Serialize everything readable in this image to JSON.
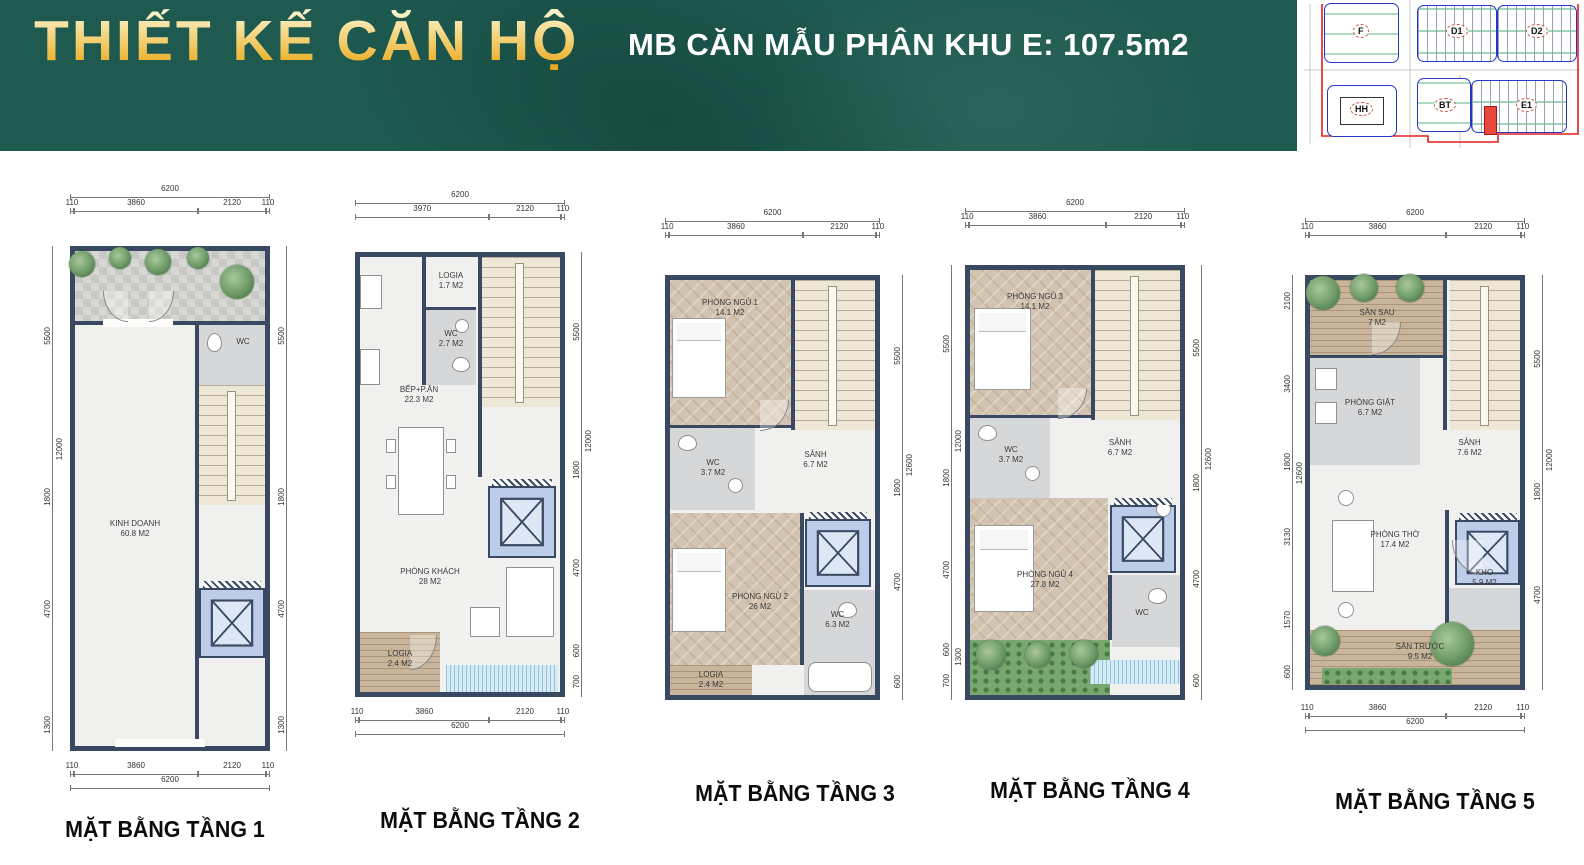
{
  "header": {
    "title": "THIẾT KẾ CĂN HỘ",
    "subtitle": "MB CĂN MẪU PHÂN KHU E: 107.5m2",
    "bg_color": "#1e5a50",
    "title_gold": "#eaa614"
  },
  "site_plan": {
    "blocks": {
      "f": "F",
      "d1": "D1",
      "d2": "D2",
      "hh": "HH",
      "bt": "BT",
      "e1": "E1"
    },
    "outline_color": "#2436c8",
    "boundary_color": "#e02020",
    "highlight_color": "#e8483e"
  },
  "plans": [
    {
      "title": "MẶT BẰNG TẦNG 1",
      "dims": {
        "top_total": "6200",
        "top_segments": [
          "110",
          "3860",
          "2120",
          "110"
        ],
        "left_segments": [
          "5500",
          "1800",
          "4700",
          "1300"
        ],
        "left_total": "12000",
        "right_segments": [
          "5500",
          "1800",
          "4700",
          "1300"
        ],
        "bottom_segments": [
          "110",
          "3860",
          "2120",
          "110"
        ],
        "bottom_total": "6200"
      },
      "rooms": {
        "kinh_doanh": {
          "name": "KINH DOANH",
          "area": "60.8 M2"
        },
        "wc": {
          "name": "WC",
          "area": ""
        }
      }
    },
    {
      "title": "MẶT BẰNG TẦNG 2",
      "dims": {
        "top_total": "6200",
        "top_segments": [
          "3970",
          "2120",
          "110"
        ],
        "right_segments": [
          "5500",
          "1800",
          "4700",
          "600",
          "700"
        ],
        "right_total": "12000",
        "bottom_segments": [
          "110",
          "3860",
          "2120",
          "110"
        ],
        "bottom_total": "6200"
      },
      "rooms": {
        "logia_top": {
          "name": "LOGIA",
          "area": "1.7 M2"
        },
        "wc": {
          "name": "WC",
          "area": "2.7 M2"
        },
        "bep": {
          "name": "BẾP+P.ĂN",
          "area": "22.3 M2"
        },
        "khach": {
          "name": "PHÒNG KHÁCH",
          "area": "28 M2"
        },
        "logia_bottom": {
          "name": "LOGIA",
          "area": "2.4 M2"
        }
      }
    },
    {
      "title": "MẶT BẰNG TẦNG 3",
      "dims": {
        "top_total": "6200",
        "top_segments": [
          "110",
          "3860",
          "2120",
          "110"
        ],
        "right_segments": [
          "5500",
          "1800",
          "4700",
          "600"
        ],
        "right_total": "12600"
      },
      "rooms": {
        "ngu1": {
          "name": "PHÒNG NGỦ 1",
          "area": "14.1 M2"
        },
        "wc1": {
          "name": "WC",
          "area": "3.7 M2"
        },
        "sanh": {
          "name": "SẢNH",
          "area": "6.7 M2"
        },
        "ngu2": {
          "name": "PHÒNG NGỦ 2",
          "area": "26 M2"
        },
        "wc2": {
          "name": "WC",
          "area": "6.3 M2"
        },
        "logia": {
          "name": "LOGIA",
          "area": "2.4 M2"
        }
      }
    },
    {
      "title": "MẶT BẰNG TẦNG 4",
      "dims": {
        "top_total": "6200",
        "top_segments": [
          "110",
          "3860",
          "2120",
          "110"
        ],
        "left_segments": [
          "5500",
          "1800",
          "4700",
          "600",
          "700"
        ],
        "left_total": "12000",
        "left_extra": "1300",
        "right_segments": [
          "5500",
          "1800",
          "4700",
          "600"
        ],
        "right_total": "12600"
      },
      "rooms": {
        "ngu3": {
          "name": "PHÒNG NGỦ 3",
          "area": "14.1 M2"
        },
        "wc1": {
          "name": "WC",
          "area": "3.7 M2"
        },
        "sanh": {
          "name": "SẢNH",
          "area": "6.7 M2"
        },
        "ngu4": {
          "name": "PHÒNG NGỦ 4",
          "area": "27.8 M2"
        },
        "wc2": {
          "name": "WC",
          "area": ""
        }
      }
    },
    {
      "title": "MẶT BẰNG TẦNG 5",
      "dims": {
        "top_total": "6200",
        "top_segments": [
          "110",
          "3860",
          "2120",
          "110"
        ],
        "left_segments": [
          "2100",
          "3400",
          "1800",
          "3130",
          "1570",
          "600"
        ],
        "left_total": "12600",
        "right_segments": [
          "5500",
          "1800",
          "4700"
        ],
        "right_total": "12000",
        "bottom_segments": [
          "110",
          "3860",
          "2120",
          "110"
        ],
        "bottom_total": "6200"
      },
      "rooms": {
        "san_sau": {
          "name": "SÂN SAU",
          "area": "7 M2"
        },
        "giat": {
          "name": "PHÒNG GIẶT",
          "area": "6.7 M2"
        },
        "sanh": {
          "name": "SẢNH",
          "area": "7.6 M2"
        },
        "tho": {
          "name": "PHÒNG THỜ",
          "area": "17.4 M2"
        },
        "kho": {
          "name": "KHO",
          "area": "5.9 M2"
        },
        "san_truoc": {
          "name": "SÂN TRƯỚC",
          "area": "9.5 M2"
        }
      }
    }
  ]
}
